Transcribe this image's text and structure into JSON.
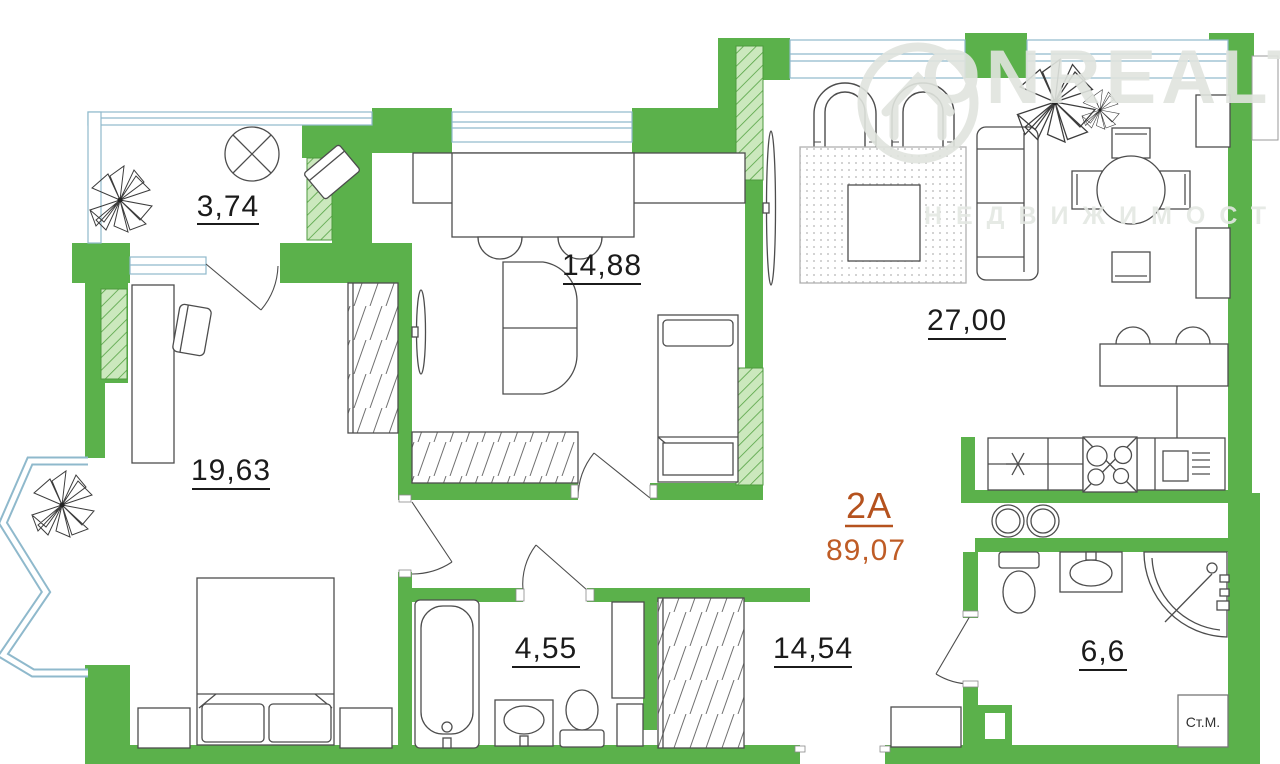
{
  "apartment": {
    "unit": "2A",
    "total_area": "89,07"
  },
  "rooms": {
    "balcony": "3,74",
    "kids_room": "14,88",
    "bedroom": "19,63",
    "living_kitchen": "27,00",
    "bathroom_small": "4,55",
    "hallway": "14,54",
    "bathroom_large": "6,6"
  },
  "appliances": {
    "washing_machine": "Ст.М."
  },
  "watermark": {
    "brand": "ONREALT",
    "tagline": "НЕДВИЖИМОСТЬ"
  },
  "colors": {
    "wall_green": "#5bb14b",
    "wall_hatch_bg": "#cbe8bd",
    "accent_orange": "#b5521e",
    "window_blue": "#8fb9cc"
  }
}
